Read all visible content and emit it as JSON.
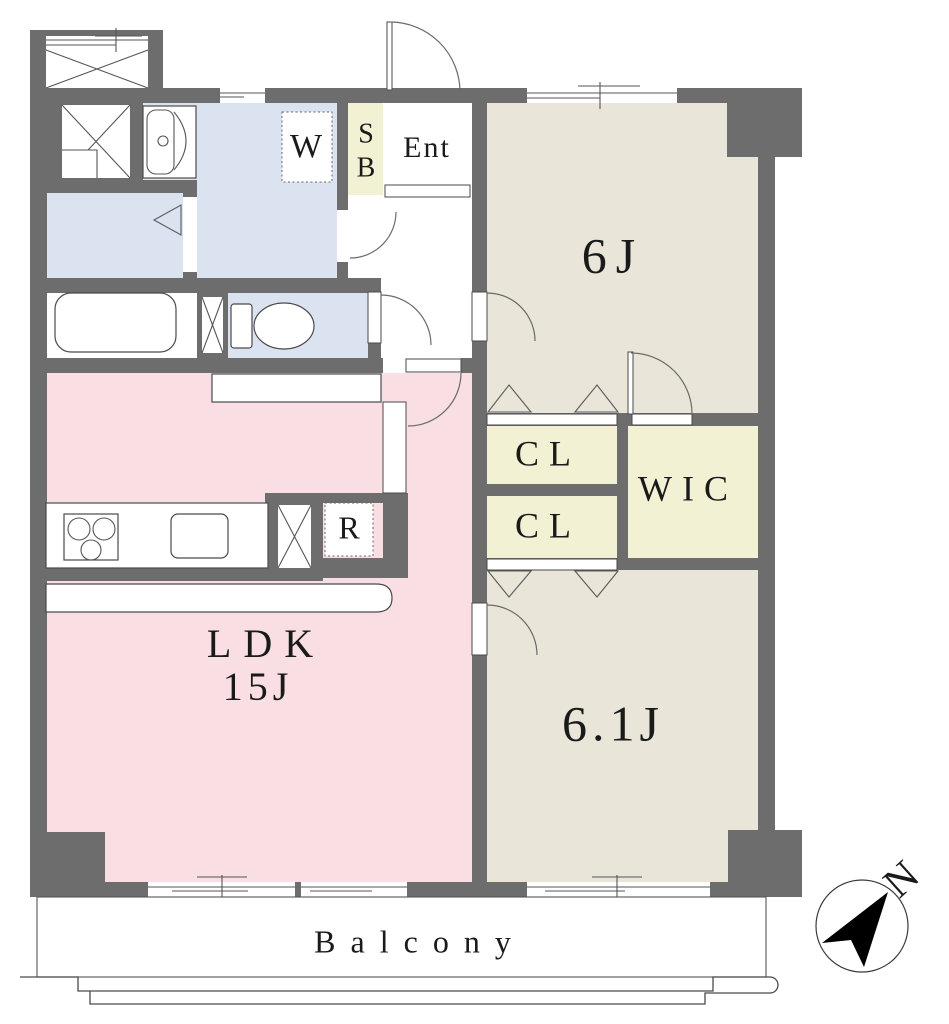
{
  "page": {
    "type": "apartment-floor-plan"
  },
  "colors": {
    "wall": "#6d6d6d",
    "ldk": "#f9dfe3",
    "bedroom": "#e9e5d9",
    "closet": "#f3f1d4",
    "wet_area": "#dbe2f0",
    "outline": "#4a4a4a",
    "text": "#1a1a1a"
  },
  "rooms": {
    "ldk": {
      "name": "LDK",
      "size": "15J"
    },
    "bedroom_north": {
      "size": "6J"
    },
    "bedroom_south": {
      "size": "6.1J"
    },
    "closet_upper": {
      "label": "CL"
    },
    "closet_lower": {
      "label": "CL"
    },
    "walk_in_closet": {
      "label": "WIC"
    },
    "entrance": {
      "label": "Ent"
    },
    "shoe_box": {
      "letter_top": "S",
      "letter_bottom": "B"
    },
    "washing_machine": {
      "label": "W"
    },
    "refrigerator": {
      "label": "R"
    },
    "balcony": {
      "label": "Balcony"
    }
  },
  "compass": {
    "north_label": "N"
  }
}
